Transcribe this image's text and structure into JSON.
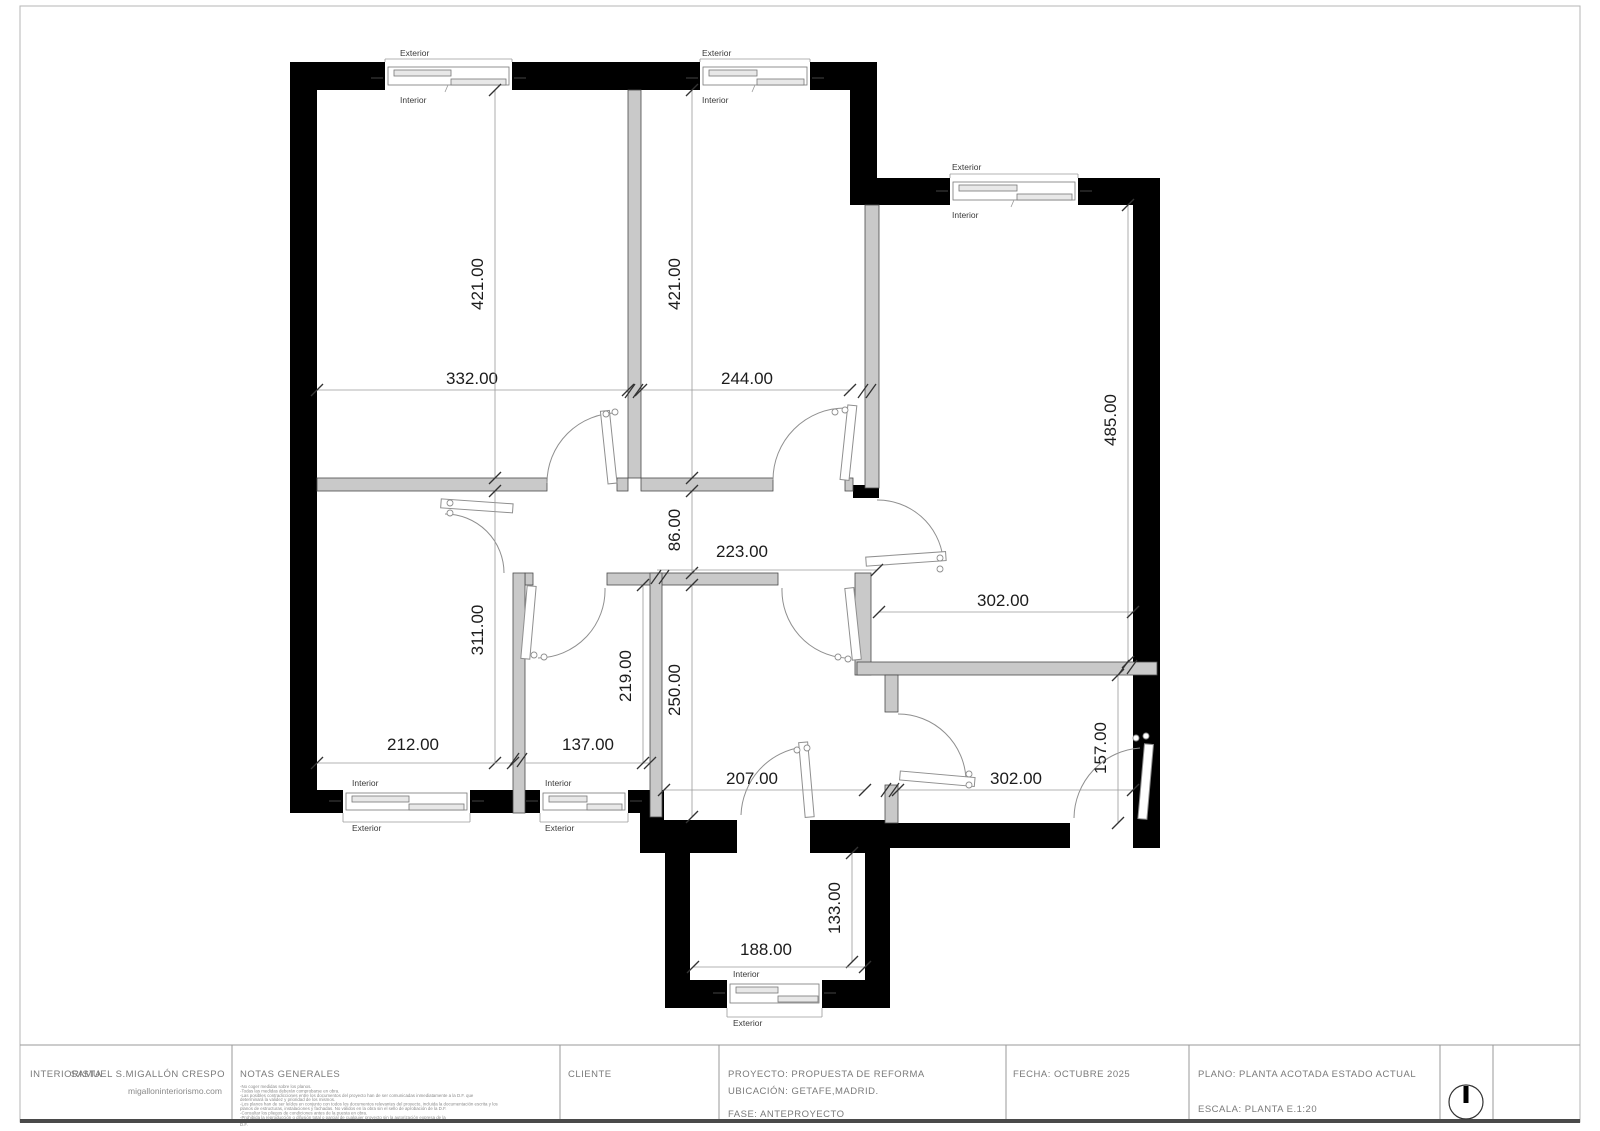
{
  "plan": {
    "window_labels": {
      "exterior": "Exterior",
      "interior": "Interior"
    },
    "dims": {
      "tl_width": "332.00",
      "tm_width": "244.00",
      "tl_height": "421.00",
      "tm_height": "421.00",
      "right_height": "485.00",
      "right_width": "302.00",
      "hall_height": "86.00",
      "hall_width": "223.00",
      "ll_height": "311.00",
      "ll_width": "212.00",
      "lm_width": "137.00",
      "lm_height": "219.00",
      "c_width": "207.00",
      "c_height": "250.00",
      "br_width": "302.00",
      "br_height": "157.00",
      "terrace_width": "188.00",
      "terrace_height": "133.00"
    }
  },
  "title_block": {
    "interiorista_label": "INTERIORISTA",
    "interiorista_name": "SAMUEL S.MIGALLÓN CRESPO",
    "interiorista_web": "migalloninteriorismo.com",
    "notas_label": "NOTAS GENERALES",
    "notas": [
      "-No coger medidas sobre los planos.",
      "-Todas las medidas deberán comprobarse en obra.",
      "-Las posibles contradicciones entre los documentos del proyecto han de ser comunicadas inmediatamente a la D.F. que",
      "determinará la validez y prioridad de los mismos.",
      "-Los planos han de ser leídos en conjunto con todos los documentos relevantes del proyecto, incluida la documentación escrita y los",
      "planos de estructuras, instalaciones y fachadas. No válidos en la obra sin el sello de aprobación de la D.F.",
      "-Consultar los pliegos de condiciones antes de la puesta en obra.",
      "-Prohibida la reproducción o difusión total o parcial de cualquier proyecto sin la autorización expresa de la",
      "D.F."
    ],
    "cliente_label": "CLIENTE",
    "proyecto": "PROYECTO: PROPUESTA DE REFORMA",
    "ubicacion": "UBICACIÓN: GETAFE,MADRID.",
    "fase": "FASE: ANTEPROYECTO",
    "fecha": "FECHA: OCTUBRE 2025",
    "plano": "PLANO: PLANTA ACOTADA ESTADO ACTUAL",
    "escala": "ESCALA: PLANTA E.1:20"
  },
  "colors": {
    "wall": "#000000",
    "partition": "#c9c9c9",
    "dimension_text": "#1c1c1c",
    "drawing_line": "#9a9a9a"
  }
}
